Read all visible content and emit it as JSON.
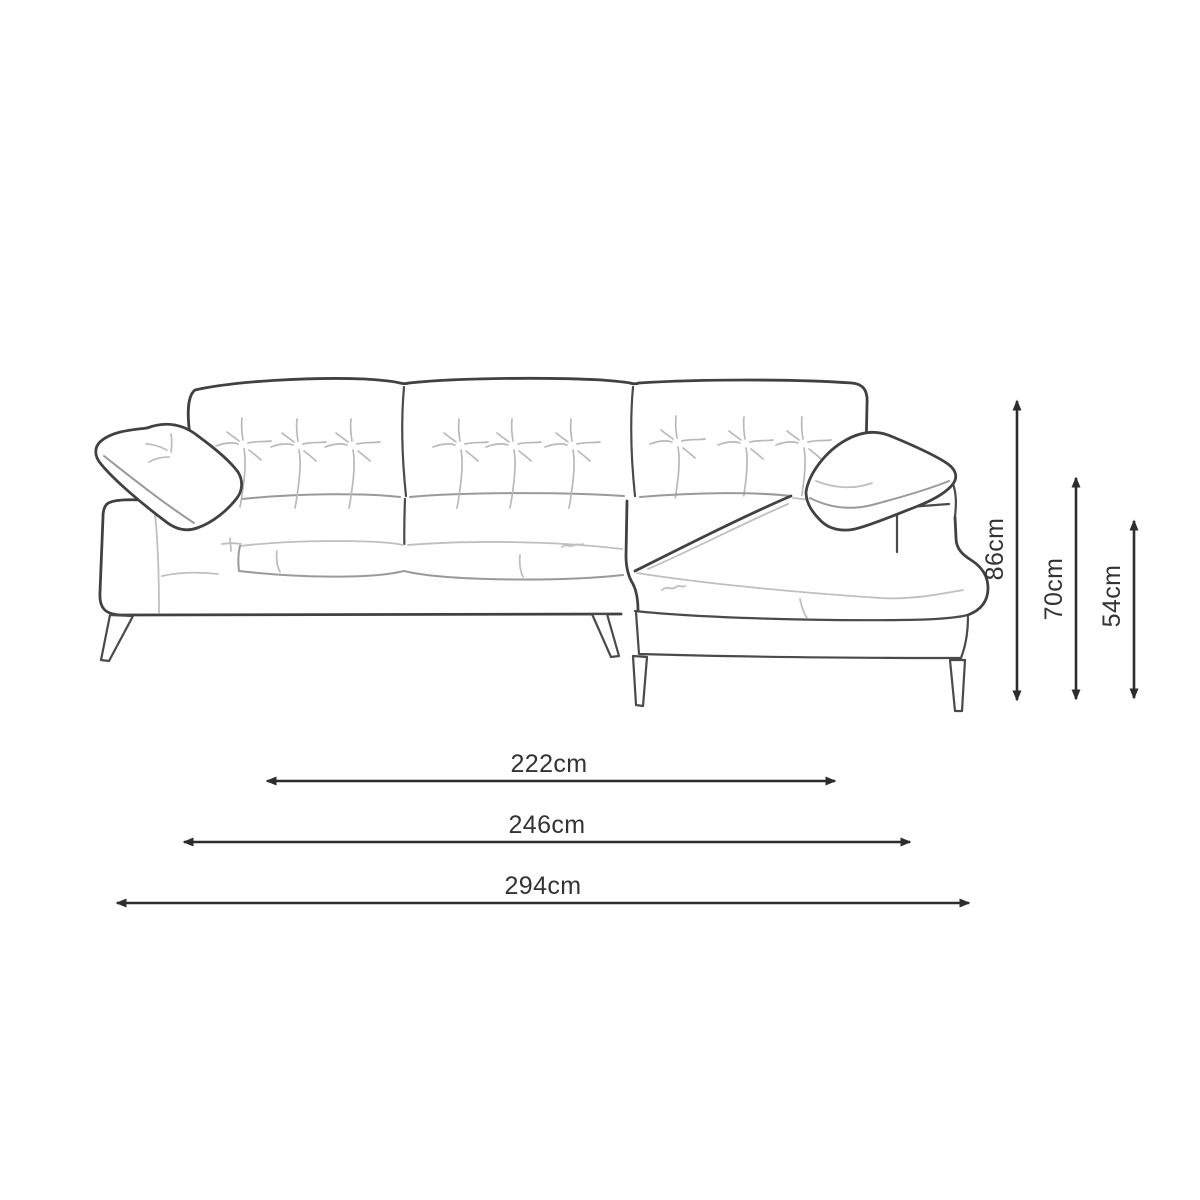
{
  "diagram": {
    "subject": "chaise-end sofa line drawing with dimensions",
    "background_color": "#ffffff",
    "outline_color": "#414141",
    "detail_line_color": "#bfbfbf",
    "dimension_color": "#2d2d2d",
    "label_color": "#333333"
  },
  "dimensions": {
    "unit": "cm",
    "vertical": [
      {
        "label": "86cm",
        "value": 86
      },
      {
        "label": "70cm",
        "value": 70
      },
      {
        "label": "54cm",
        "value": 54
      }
    ],
    "horizontal": [
      {
        "label": "222cm",
        "value": 222
      },
      {
        "label": "246cm",
        "value": 246
      },
      {
        "label": "294cm",
        "value": 294
      }
    ]
  }
}
